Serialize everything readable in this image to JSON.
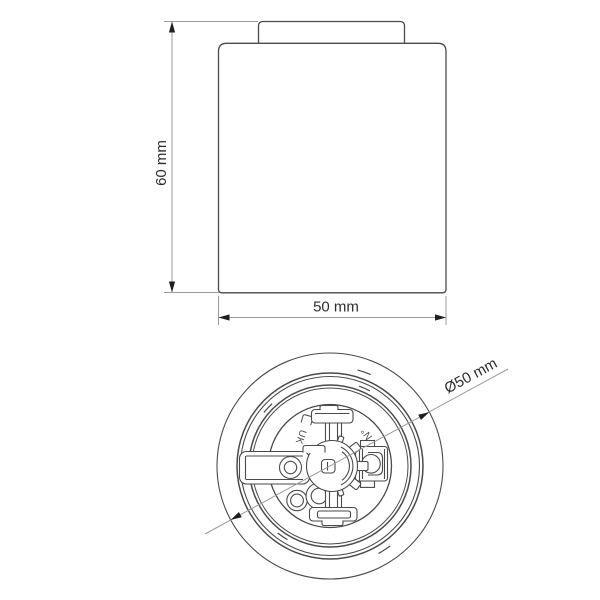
{
  "drawing": {
    "background": "#ffffff",
    "line_color": "#4a4a4a",
    "dim_line_color": "#9b9b9b",
    "arrow_color": "#1f1f1f",
    "text_color": "#2d2d2d",
    "side_view": {
      "height_label": "60 mm",
      "width_label": "50 mm"
    },
    "bottom_view": {
      "diameter_label": "Ø50 mm",
      "marking_left": "UK",
      "marking_right": "N°"
    }
  }
}
